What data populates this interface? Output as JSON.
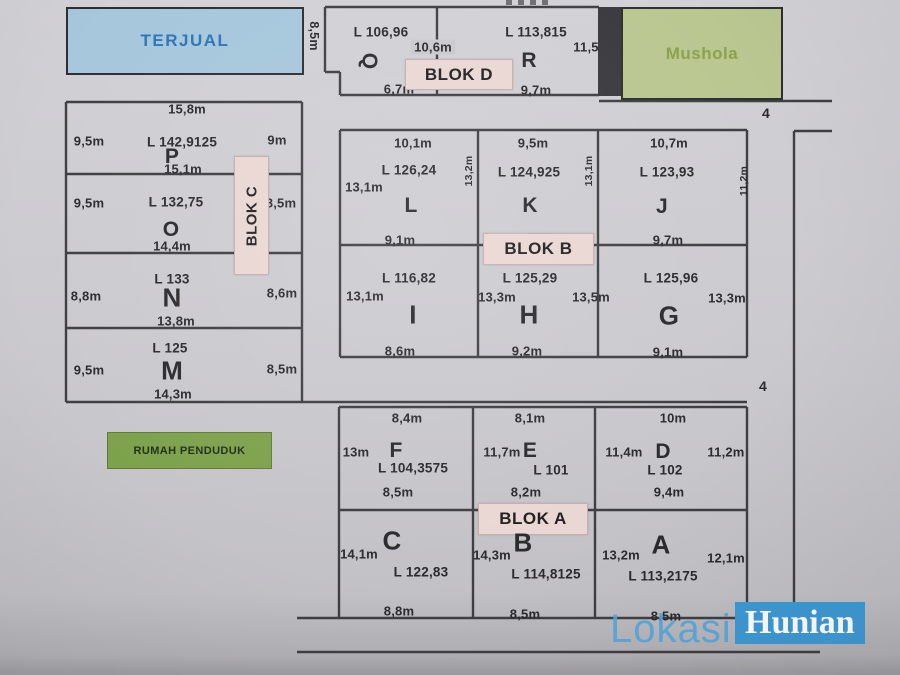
{
  "legend": {
    "terjual": "TERJUAL",
    "mushola": "Mushola",
    "rumah_penduduk": "RUMAH PENDUDUK"
  },
  "blocks": {
    "a": "BLOK A",
    "b": "BLOK B",
    "c": "BLOK C",
    "d": "BLOK D"
  },
  "roads": {
    "label_top": "4",
    "label_mid": "4"
  },
  "watermark": {
    "lokasi": "Lokasi",
    "hunian": "Hunian"
  },
  "colors": {
    "terjual_fill": "#a6c7dc",
    "terjual_text": "#2e75b6",
    "mushola_fill": "#bac791",
    "mushola_text": "#8ba24c",
    "blok_label_fill": "#ead7d3",
    "rumah_fill": "#7da24c",
    "watermark_blue": "#3f9ad5",
    "line": "#3f3f42",
    "paper": "#cac9ce"
  },
  "plots": {
    "P": {
      "id": "P",
      "area": "L 142,9125",
      "top": "15,8m",
      "left": "9,5m",
      "right": "9m",
      "bottom": "15,1m"
    },
    "O": {
      "id": "O",
      "area": "L 132,75",
      "left": "9,5m",
      "right": "8,5m",
      "bottom": "14,4m"
    },
    "N": {
      "id": "N",
      "area": "L 133",
      "left": "8,8m",
      "right": "8,6m",
      "bottom": "13,8m"
    },
    "M": {
      "id": "M",
      "area": "L 125",
      "left": "9,5m",
      "right": "8,5m",
      "bottom": "14,3m"
    },
    "Q": {
      "id": "Q",
      "area": "L 106,96",
      "left": "8,5m",
      "top": "10,6m",
      "bottom": "6,7m"
    },
    "R": {
      "id": "R",
      "area": "L 113,815",
      "right": "11,5",
      "bottom": "9,7m"
    },
    "L": {
      "id": "L",
      "area": "L 126,24",
      "top": "10,1m",
      "left": "13,1m",
      "right": "13,2m",
      "bottom": "9,1m"
    },
    "K": {
      "id": "K",
      "area": "L 124,925",
      "top": "9,5m",
      "right": "13,1m"
    },
    "J": {
      "id": "J",
      "area": "L 123,93",
      "top": "10,7m",
      "right": "11,2m",
      "bottom": "9,7m"
    },
    "I": {
      "id": "I",
      "area": "L 116,82",
      "left": "13,1m",
      "bottom": "8,6m"
    },
    "H": {
      "id": "H",
      "area": "L 125,29",
      "left": "13,3m",
      "right": "13,5m",
      "bottom": "9,2m"
    },
    "G": {
      "id": "G",
      "area": "L 125,96",
      "right": "13,3m",
      "bottom": "9,1m"
    },
    "F": {
      "id": "F",
      "area": "L 104,3575",
      "top": "8,4m",
      "left": "13m",
      "bottom": "8,5m"
    },
    "E": {
      "id": "E",
      "area": "L 101",
      "top": "8,1m",
      "left": "11,7m",
      "bottom": "8,2m"
    },
    "D": {
      "id": "D",
      "area": "L 102",
      "top": "10m",
      "left": "11,4m",
      "right": "11,2m",
      "bottom": "9,4m"
    },
    "C": {
      "id": "C",
      "area": "L 122,83",
      "left": "14,1m",
      "bottom": "8,8m"
    },
    "B": {
      "id": "B",
      "area": "L 114,8125",
      "left": "14,3m",
      "bottom": "8,5m"
    },
    "A": {
      "id": "A",
      "area": "L 113,2175",
      "left": "13,2m",
      "right": "12,1m",
      "bottom": "8,5m"
    }
  }
}
